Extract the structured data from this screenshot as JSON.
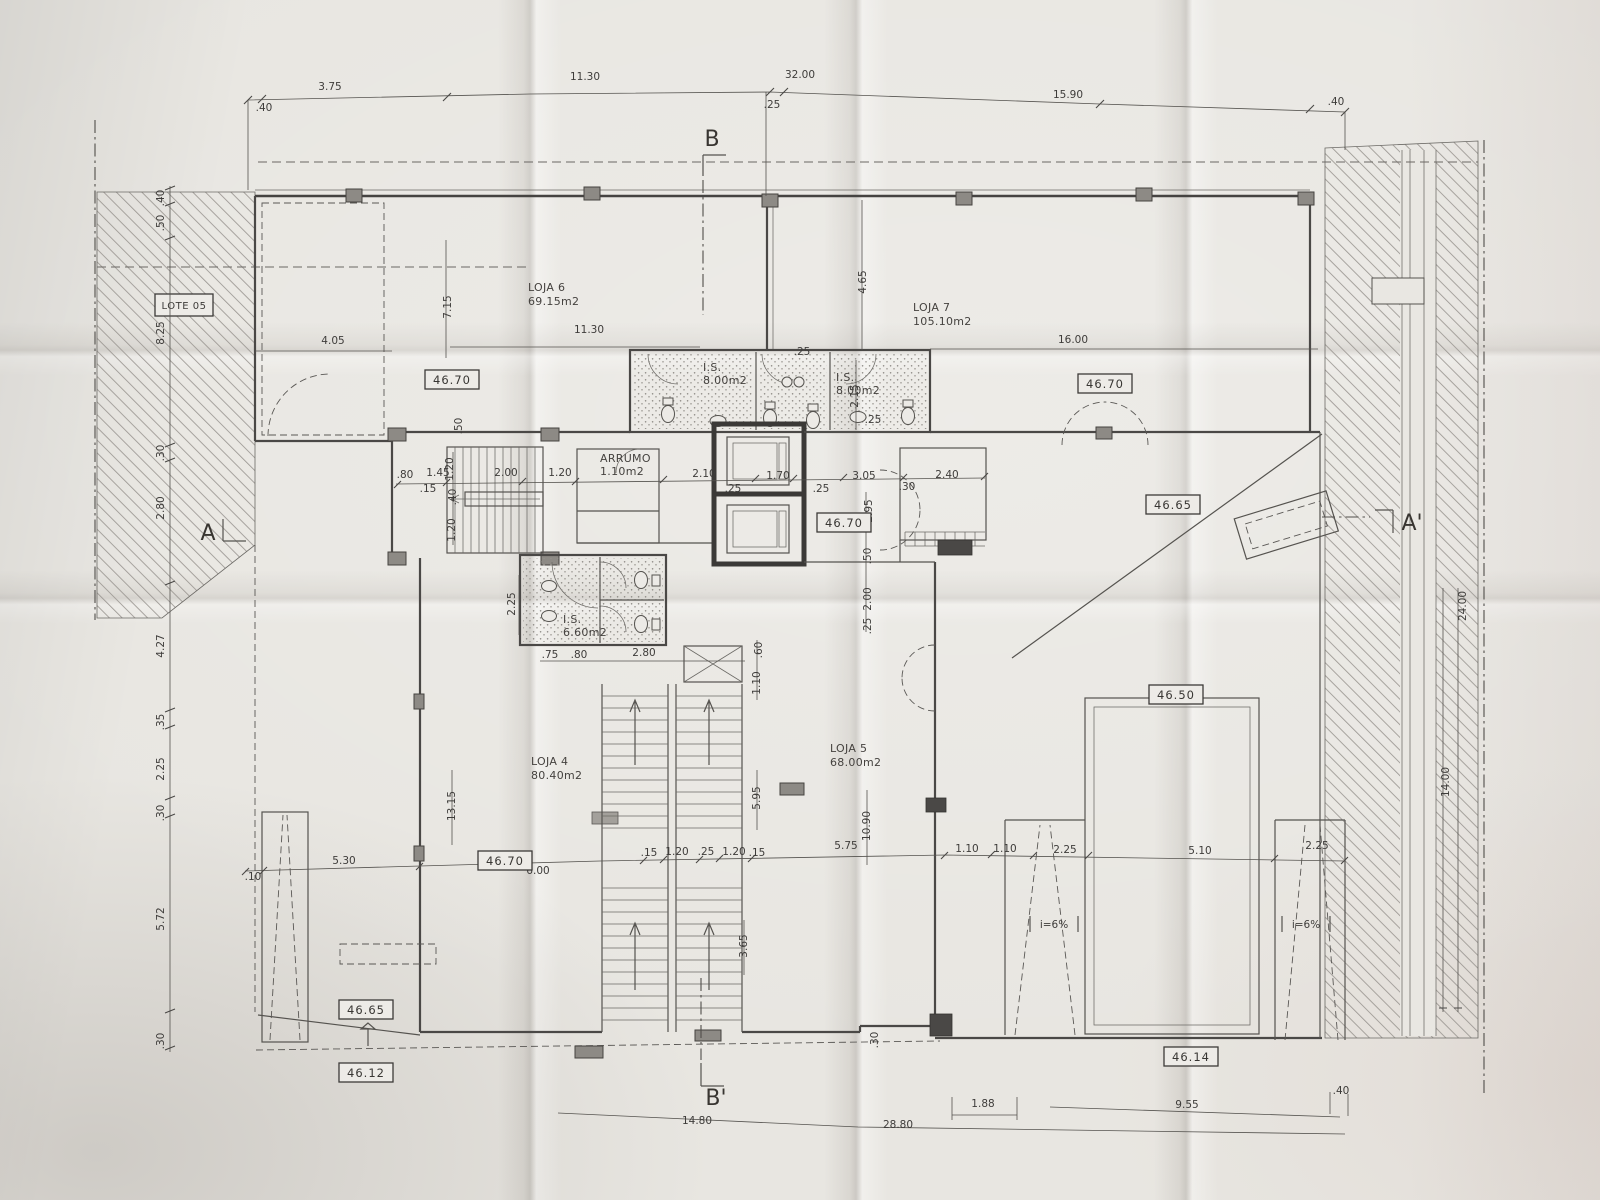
{
  "sections": {
    "top": "B",
    "bottom": "B'",
    "left": "A",
    "right": "A'"
  },
  "site": {
    "lot": "LOTE 05"
  },
  "rooms": {
    "loja6": {
      "name": "LOJA 6",
      "area": "69.15m2"
    },
    "loja7": {
      "name": "LOJA 7",
      "area": "105.10m2"
    },
    "loja4": {
      "name": "LOJA 4",
      "area": "80.40m2"
    },
    "loja5": {
      "name": "LOJA 5",
      "area": "68.00m2"
    },
    "is_top_left": {
      "name": "I.S.",
      "area": "8.00m2"
    },
    "is_top_right": {
      "name": "I.S.",
      "area": "8.00m2"
    },
    "is_lower": {
      "name": "I.S.",
      "area": "6.60m2"
    },
    "arrumo": {
      "name": "ARRUMO",
      "area": "1.10m2"
    }
  },
  "levels": {
    "top_left": "46.70",
    "top_right": "46.70",
    "core": "46.70",
    "entry": "46.70",
    "terrace_right": "46.65",
    "patio_left": "46.65",
    "terrace_lower": "46.50",
    "street_right": "46.14",
    "street_left": "46.12"
  },
  "ramps": {
    "left": "i=6%",
    "right": "i=6%"
  },
  "dims": {
    "top": {
      "d40l": ".40",
      "d375": "3.75",
      "d1130": "11.30",
      "d3200": "32.00",
      "d25": ".25",
      "d1590": "15.90",
      "d40r": ".40"
    },
    "left": {
      "d40": ".40",
      "d50": ".50",
      "d825": "8.25",
      "d30a": ".30",
      "d280": "2.80",
      "d427": "4.27",
      "d35": ".35",
      "d225": "2.25",
      "d30b": ".30",
      "d572": "5.72",
      "d30c": ".30"
    },
    "upper": {
      "d715": "7.15",
      "d405": "4.05",
      "d1130": "11.30",
      "d465": "4.65",
      "d1600": "16.00",
      "d215": "2.15",
      "d25a": ".25",
      "d25b": ".25",
      "d50": ".50"
    },
    "core": {
      "d80": ".80",
      "d145": "1.45",
      "d15": ".15",
      "d120v1": "1.20",
      "d200": "2.00",
      "d120": "1.20",
      "d40v": ".40",
      "d120v2": "1.20",
      "d210": "2.10",
      "d25a": ".25",
      "d170": "1.70",
      "d25b": ".25",
      "d305": "3.05",
      "d30": ".30",
      "d240": "2.40",
      "d295": "2.95",
      "d50v": ".50",
      "d200v": "2.00",
      "d25v": ".25",
      "d225v": "2.25"
    },
    "mid": {
      "d75": ".75",
      "d80": ".80",
      "d280": "2.80",
      "d60": ".60",
      "d110": "1.10",
      "d1315": "13.15",
      "d595": "5.95",
      "d1090": "10.90",
      "d365": "3.65"
    },
    "lower": {
      "d10": ".10",
      "d530": "5.30",
      "d600": "6.00",
      "d15a": ".15",
      "d120a": "1.20",
      "d25": ".25",
      "d120b": "1.20",
      "d15b": ".15",
      "d575": "5.75",
      "d110a": "1.10",
      "d110b": "1.10",
      "d225a": "2.25",
      "d510": "5.10",
      "d225b": "2.25"
    },
    "right": {
      "d2400": "24.00",
      "d1400": "14.00"
    },
    "bottom": {
      "d1480": "14.80",
      "d2880": "28.80",
      "d188": "1.88",
      "d30": ".30",
      "d955": "9.55",
      "d40": ".40"
    }
  }
}
